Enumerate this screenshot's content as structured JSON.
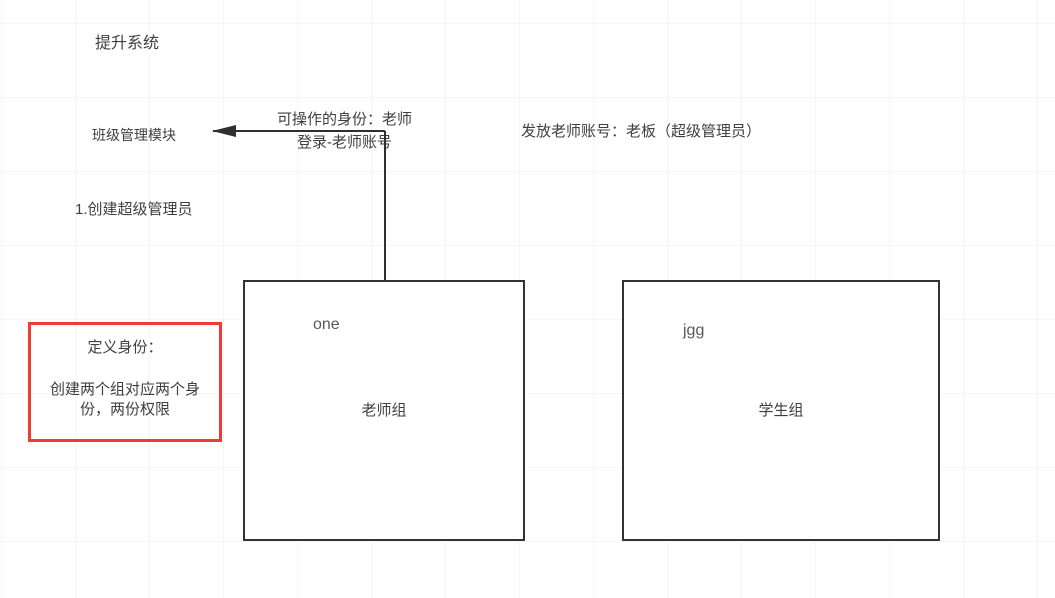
{
  "diagram": {
    "title": "提升系统",
    "module_label": "班级管理模块",
    "arrow_label": {
      "line1": "可操作的身份：老师",
      "line2": "登录-老师账号"
    },
    "issue_account_label": "发放老师账号：老板（超级管理员）",
    "step_label": "1.创建超级管理员",
    "note": {
      "heading": "定义身份：",
      "body": "创建两个组对应两个身份，两份权限"
    },
    "groups": [
      {
        "tag": "one",
        "name": "老师组"
      },
      {
        "tag": "jgg",
        "name": "学生组"
      }
    ]
  },
  "colors": {
    "background": "#ffffff",
    "grid": "#f5f5f5",
    "stroke": "#2f2f2f",
    "box_border": "#333333",
    "text": "#3f3f3f",
    "muted_text": "#595959",
    "note_border": "#ee3b35"
  }
}
